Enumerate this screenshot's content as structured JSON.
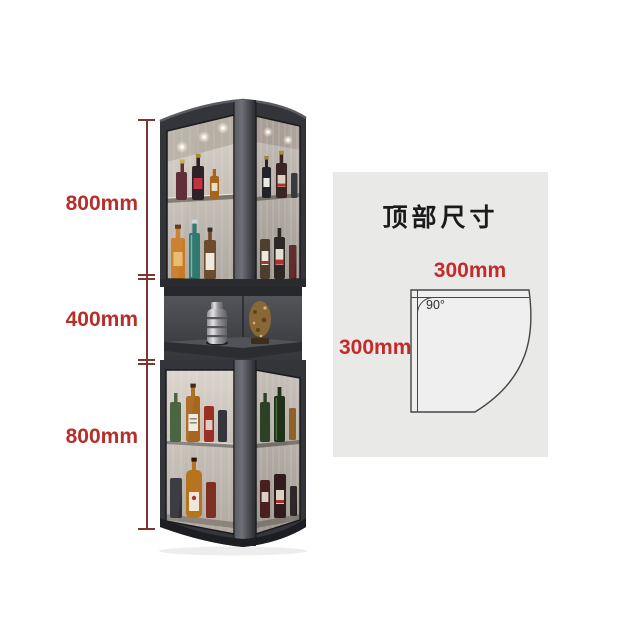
{
  "image": {
    "kind": "corner-cabinet-dimension-diagram",
    "background": "#ffffff"
  },
  "colors": {
    "dimension_text": "#b52f2b",
    "dimension_line": "#7c362f",
    "panel_background": "#e9e9e8",
    "cabinet_frame": "#34353a",
    "accent_red": "#c32b2b",
    "title_black": "#1b1b1b"
  },
  "left_dimensions": {
    "segments": [
      {
        "label": "800mm"
      },
      {
        "label": "400mm"
      },
      {
        "label": "800mm"
      }
    ]
  },
  "top_view": {
    "title": "顶部尺寸",
    "width_label": "300mm",
    "depth_label": "300mm",
    "angle_label": "90°"
  }
}
